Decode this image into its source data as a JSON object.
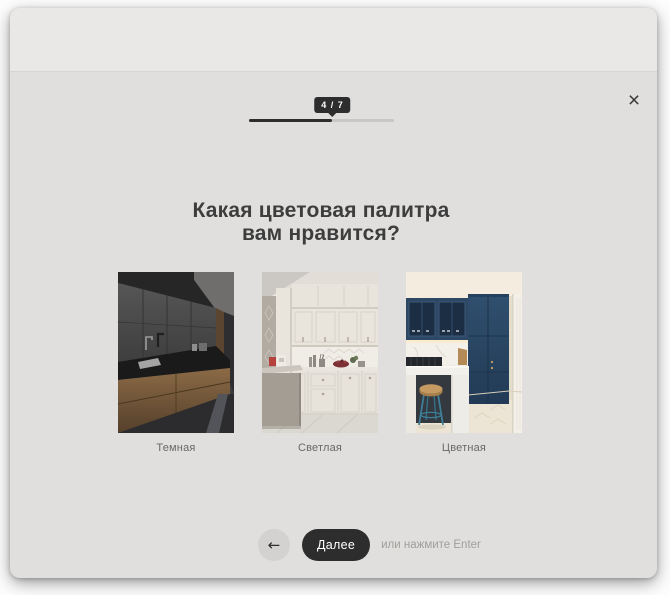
{
  "window": {
    "close_icon": "×"
  },
  "progress": {
    "label": "4 / 7",
    "current": 4,
    "total": 7
  },
  "question": {
    "title_line1": "Какая цветовая палитра",
    "title_line2": "вам нравится?"
  },
  "options": [
    {
      "label": "Темная",
      "image": "dark-kitchen-photo"
    },
    {
      "label": "Светлая",
      "image": "light-kitchen-photo"
    },
    {
      "label": "Цветная",
      "image": "blue-kitchen-photo"
    }
  ],
  "footer": {
    "back_icon": "←",
    "next_label": "Далее",
    "hint": "или нажмите Enter"
  },
  "colors": {
    "header_bg": "#e9e8e6",
    "body_bg": "#e0dfdd",
    "accent_dark": "#2d2d2d",
    "progress_track": "#c8c7c5",
    "title_text": "#3d3d3d",
    "caption_text": "#6b6866",
    "hint_text": "#a09e9b",
    "back_circle_bg": "#d3d2d0",
    "dark_kitchen_wood": "#8b6a46",
    "blue_kitchen_navy": "#2c4865"
  }
}
